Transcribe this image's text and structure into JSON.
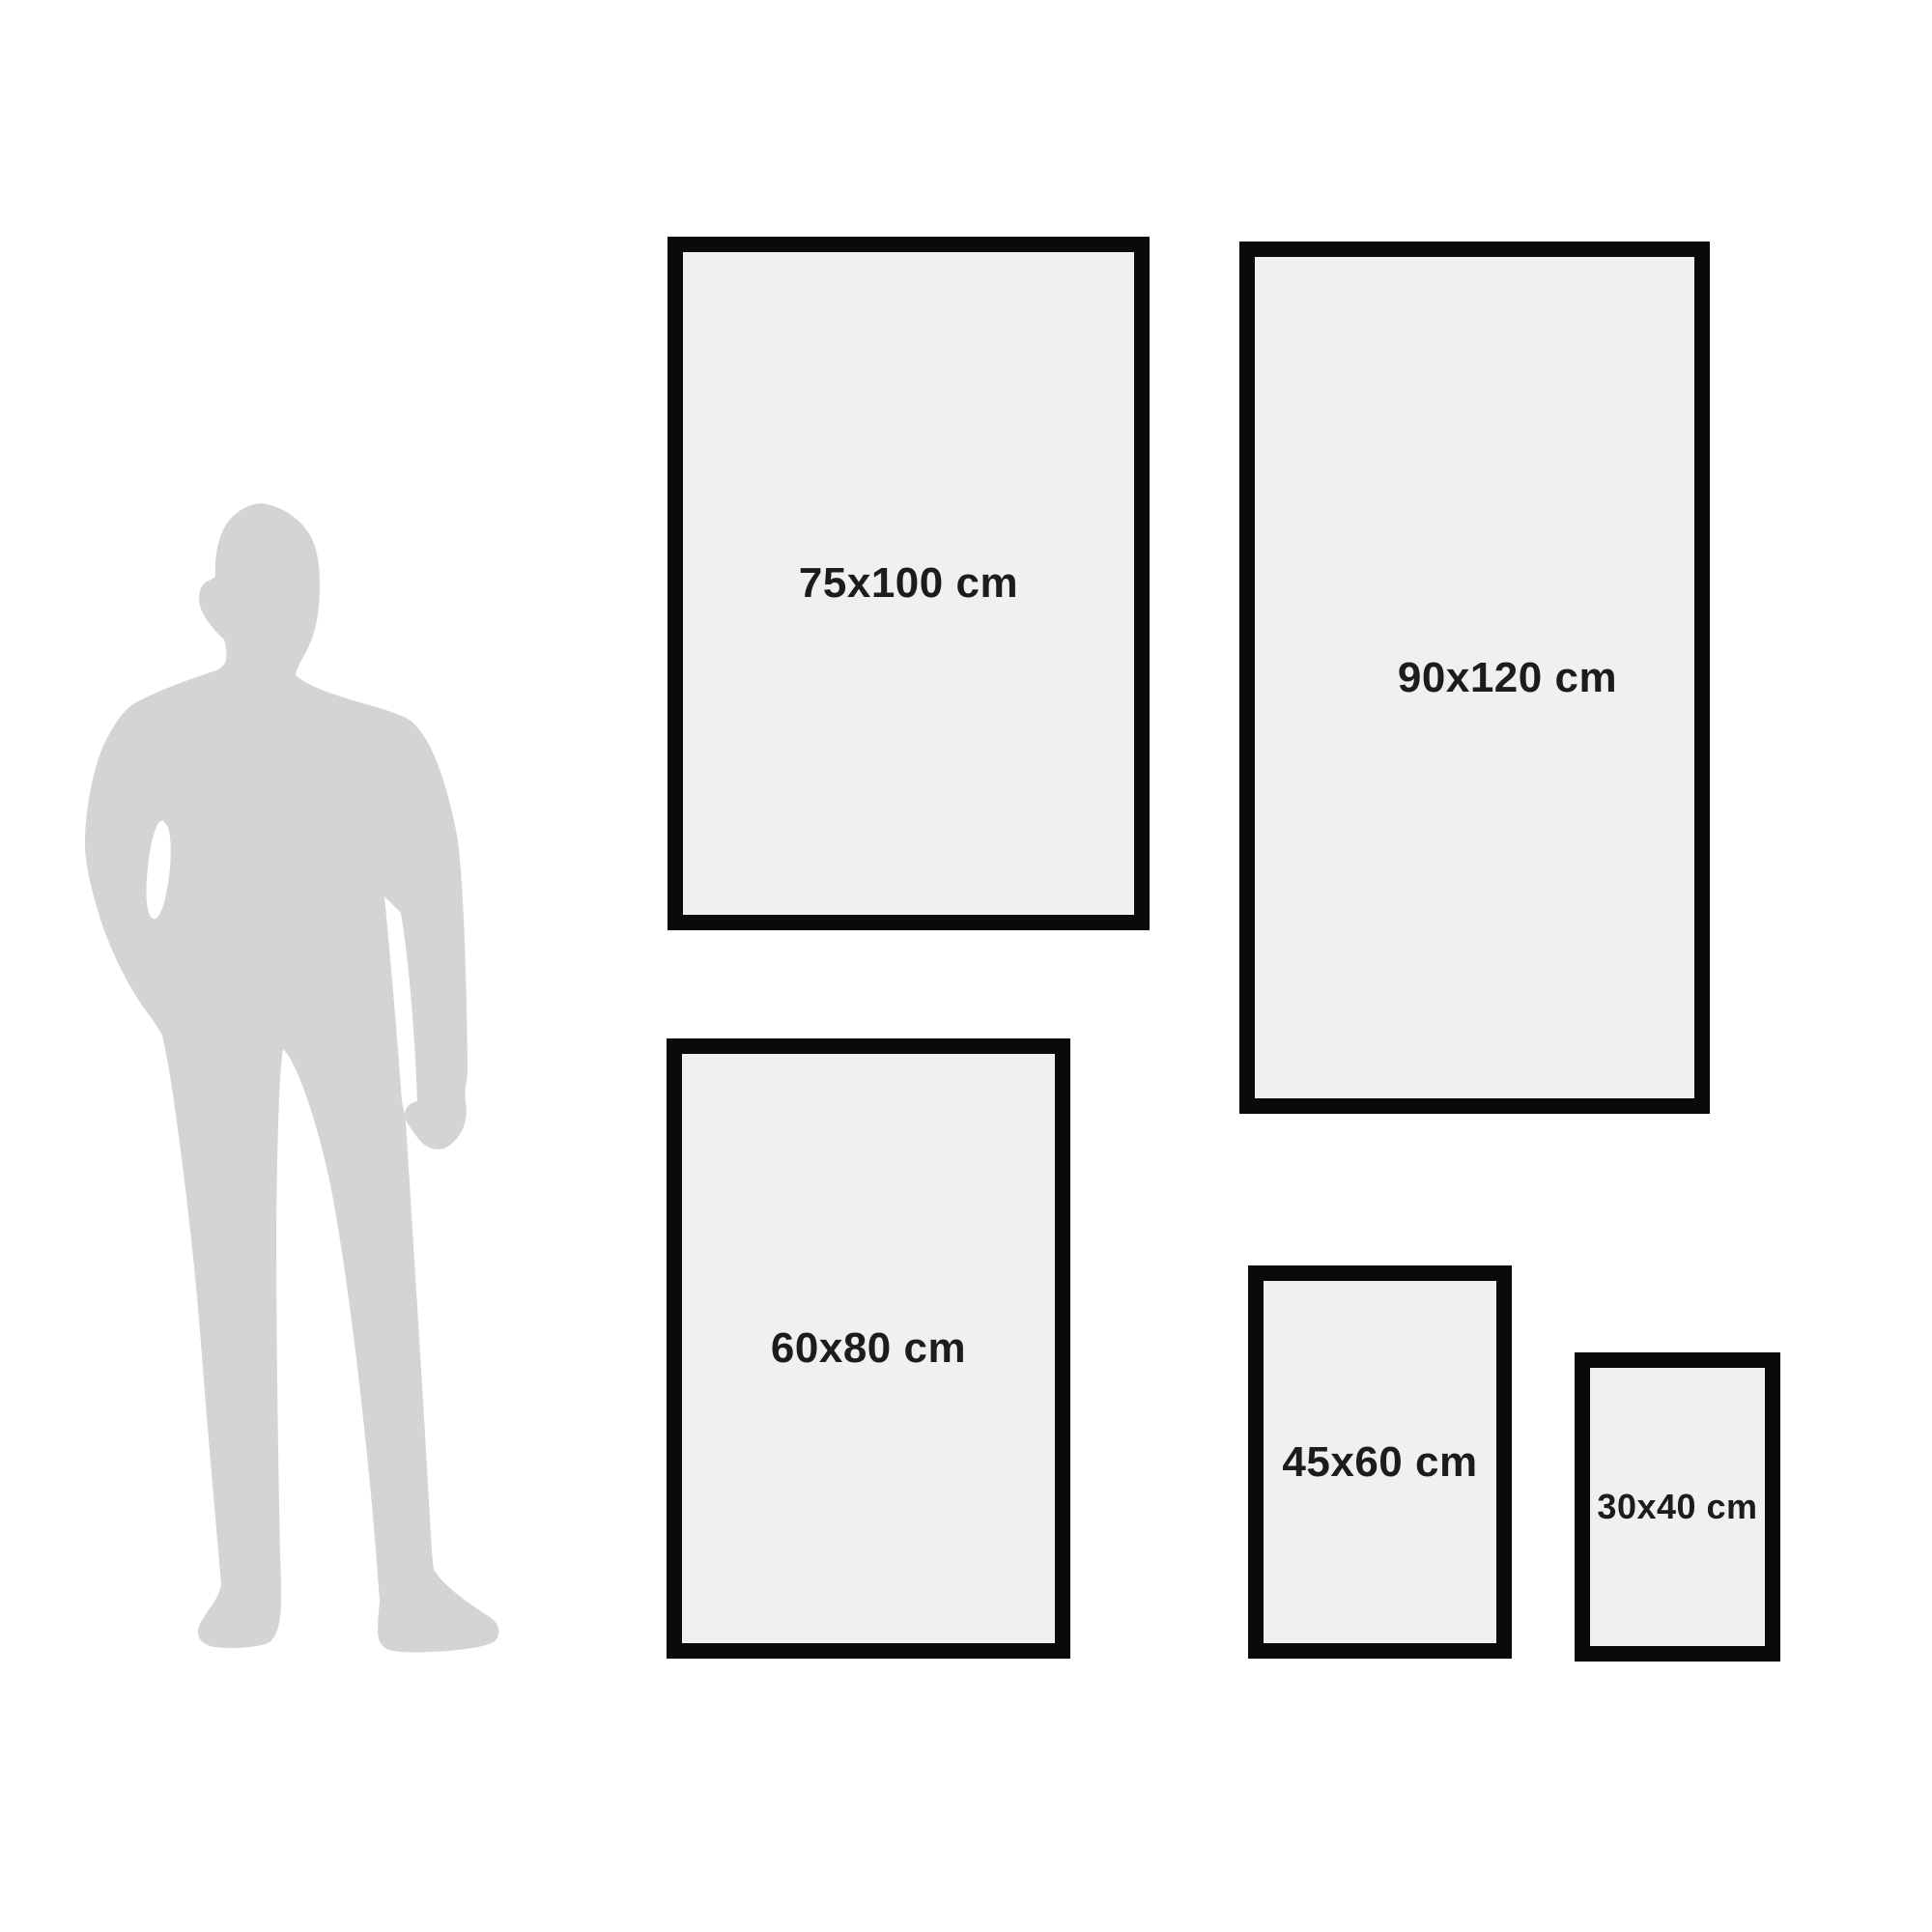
{
  "silhouette": {
    "description": "standing man in suit, shown for scale",
    "color": "#d3d4d6"
  },
  "frames": [
    {
      "id": "size-75x100",
      "label": "75x100 cm"
    },
    {
      "id": "size-90x120",
      "label": "90x120 cm"
    },
    {
      "id": "size-60x80",
      "label": "60x80 cm"
    },
    {
      "id": "size-45x60",
      "label": "45x60 cm"
    },
    {
      "id": "size-30x40",
      "label": "30x40 cm"
    }
  ],
  "style": {
    "background": "#ffffff",
    "frame_border_color": "#0a0a0a",
    "frame_fill": "#f0f0f0",
    "label_color": "#1c1c1c"
  }
}
